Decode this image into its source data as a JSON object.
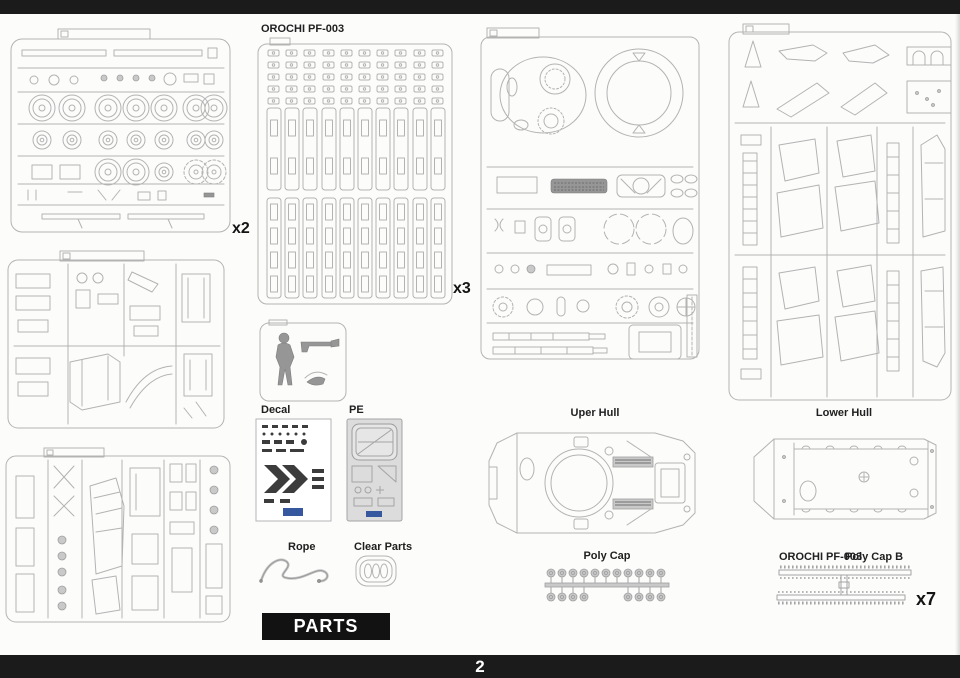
{
  "page": {
    "number": "2"
  },
  "banner": {
    "label": "PARTS"
  },
  "sprues": {
    "wheel_multiplier": "x2",
    "track_code": "OROCHI PF-003",
    "track_multiplier": "x3"
  },
  "sections": {
    "decal_label": "Decal",
    "pe_label": "PE",
    "rope_label": "Rope",
    "clear_parts_label": "Clear Parts",
    "upper_hull_label": "Uper Hull",
    "lower_hull_label": "Lower Hull",
    "poly_cap_label": "Poly Cap",
    "poly_cap_b_code": "OROCHI PF-003",
    "poly_cap_b_label": "Poly Cap B",
    "poly_cap_b_multiplier": "x7"
  }
}
